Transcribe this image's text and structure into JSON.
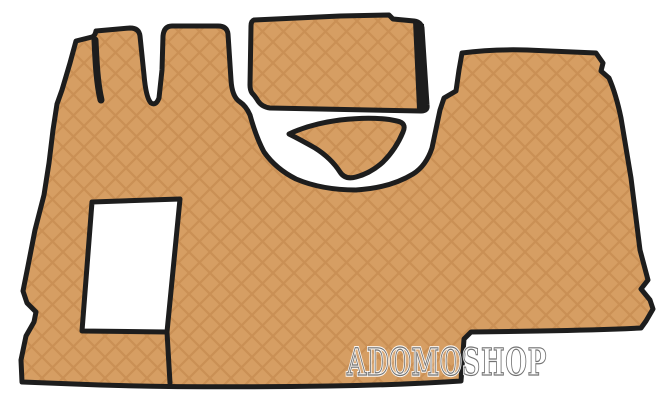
{
  "photo": {
    "alt": "Beige quilted leather truck cab floor mat set with black trim, photographed on a white background",
    "watermark": {
      "text": "ADOMOSHOP",
      "halo": "#ffffff",
      "outline": "#737373"
    },
    "colors": {
      "mat": "#d69e63",
      "stitch": "#bf8549",
      "trim": "#1d1d1d",
      "background": "#ffffff",
      "cutout": "#ffffff"
    },
    "pieces": [
      {
        "id": "main-mat",
        "label": "Main cab floor mat with seat and console cutouts"
      },
      {
        "id": "tunnel-mat",
        "label": "Engine tunnel cover mat (top rectangle)"
      },
      {
        "id": "hump-mat",
        "label": "Gear hump mat (small triangle)"
      }
    ]
  }
}
